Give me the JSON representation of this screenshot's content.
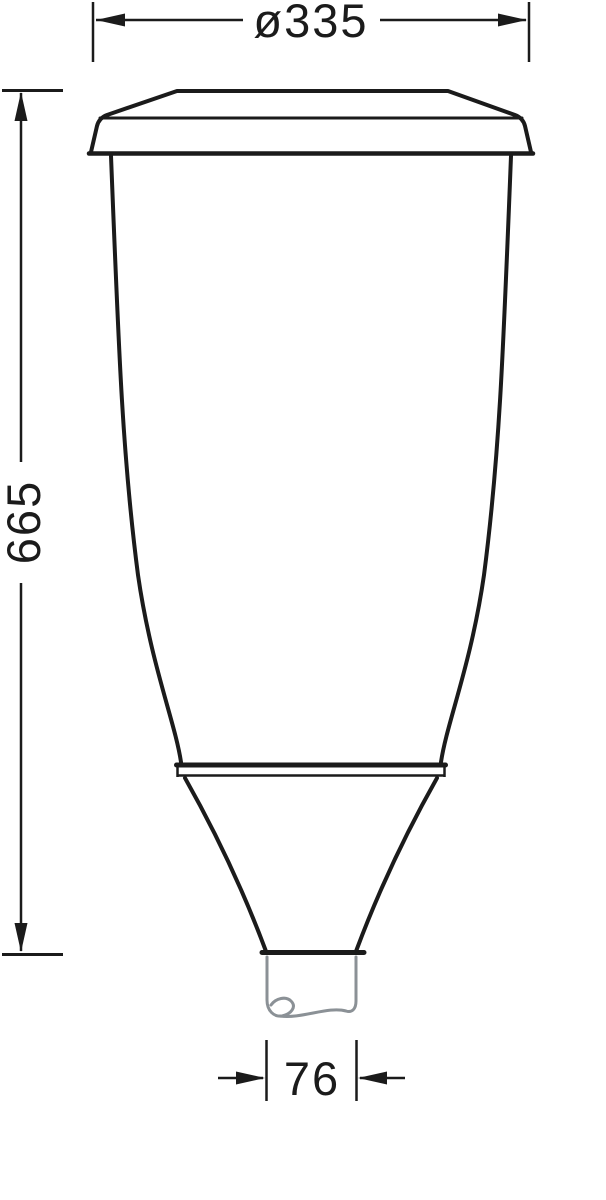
{
  "dimensions": {
    "diameter": {
      "value": "ø335"
    },
    "height": {
      "value": "665"
    },
    "spigot_width": {
      "value": "76"
    }
  },
  "colors": {
    "outline": "#1b1b1b",
    "spigot": "#8b9196",
    "background": "#ffffff"
  }
}
